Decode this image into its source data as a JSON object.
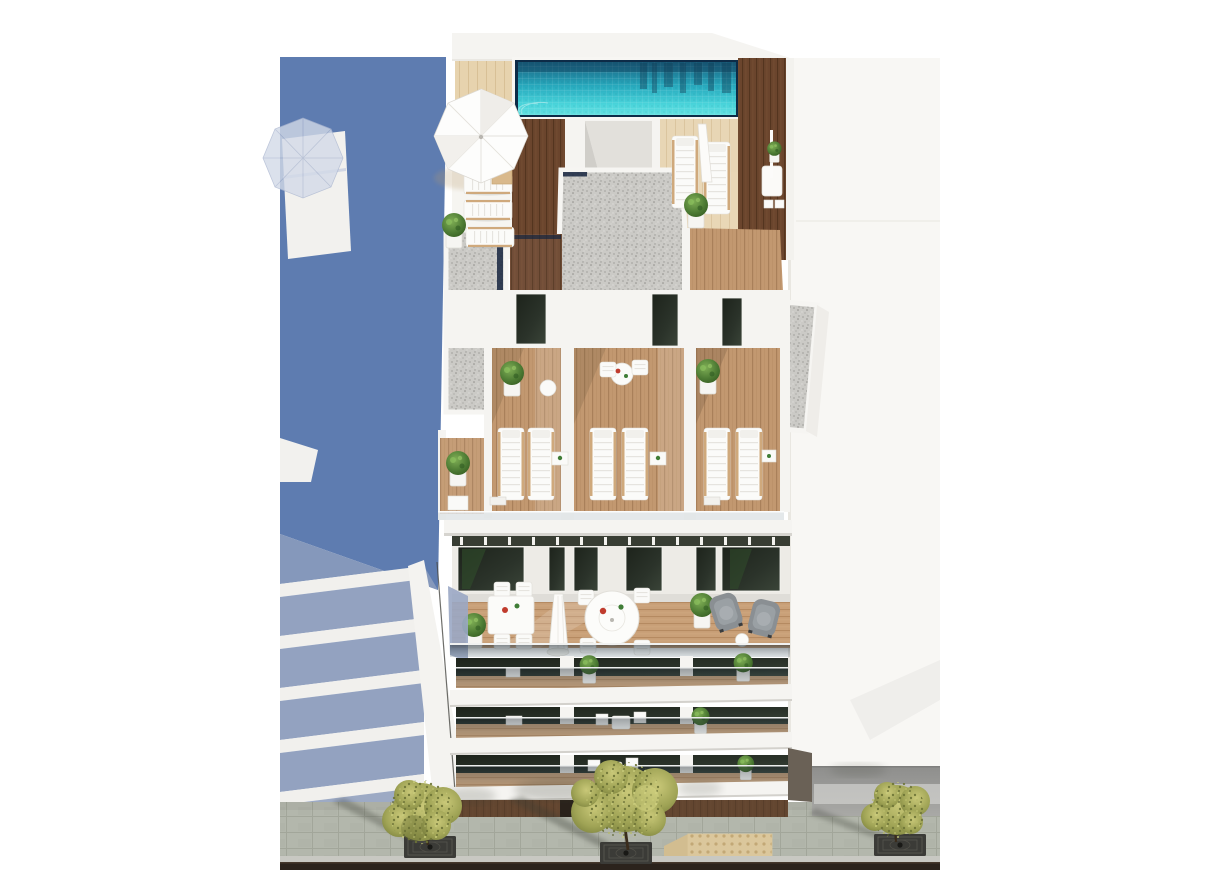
{
  "scene": {
    "type": "3d-architectural-render",
    "view": "aerial-top-down",
    "subject": "white-apartment-building-with-rooftop-pool",
    "objects": [
      "rooftop-swimming-pool",
      "pool-glass-rim",
      "sun-parasol",
      "rooftop-sun-loungers",
      "rooftop-wood-deck",
      "gravel-roof-sections",
      "glass-balustrades",
      "penthouse-terraces",
      "terrace-sun-loungers",
      "bistro-table-sets",
      "round-dining-table",
      "square-dining-table",
      "gray-armchairs",
      "potted-plants",
      "balcony-floors",
      "dark-glazed-windows",
      "ground-floor-timber-facade",
      "street-sidewalk",
      "street-trees",
      "tree-grates",
      "tactile-paving-patch",
      "road-curb",
      "neighbor-building-slabs",
      "adjacent-building-shadow",
      "shadow-parasol-silhouette"
    ],
    "counts": {
      "street_trees": 3,
      "lower_balcony_bands": 3,
      "terrace_bays": 3
    }
  },
  "colors": {
    "background": "#ffffff",
    "shadow_blue": "#5e7cb0",
    "shadow_blue_light": "#93a2c0",
    "shadow_blue_gap": "#8598bb",
    "wall_white": "#f5f4f1",
    "wall_shade": "#e4e2dd",
    "pool_border": "#0d2b47",
    "pool_water": "#2ab5c4",
    "pool_deep": "#19607f",
    "pool_light": "#4fd6dd",
    "deck_tan": "#e7d3ae",
    "wood_dark": "#6b452d",
    "wood_light": "#c29870",
    "wood_floor": "#c9a078",
    "gravel": "#cbcac6",
    "glass_navy": "#16253e",
    "window_glass": "#242a20",
    "pavement": "#b3b7ac",
    "pavement_line": "#a2a69a",
    "curb_light": "#c8c8c2",
    "road_dark": "#2b231c",
    "gray_wall": "#9a9a97",
    "tactile": "#dbc79c",
    "street_tree": "#9fa355",
    "plant_green": "#4c7a33",
    "armchair_gray": "#8a8f93",
    "parasol_white": "#fdfdfc",
    "side_wall": "#f8f7f4",
    "ground_floor_timber": "#5c4633"
  }
}
